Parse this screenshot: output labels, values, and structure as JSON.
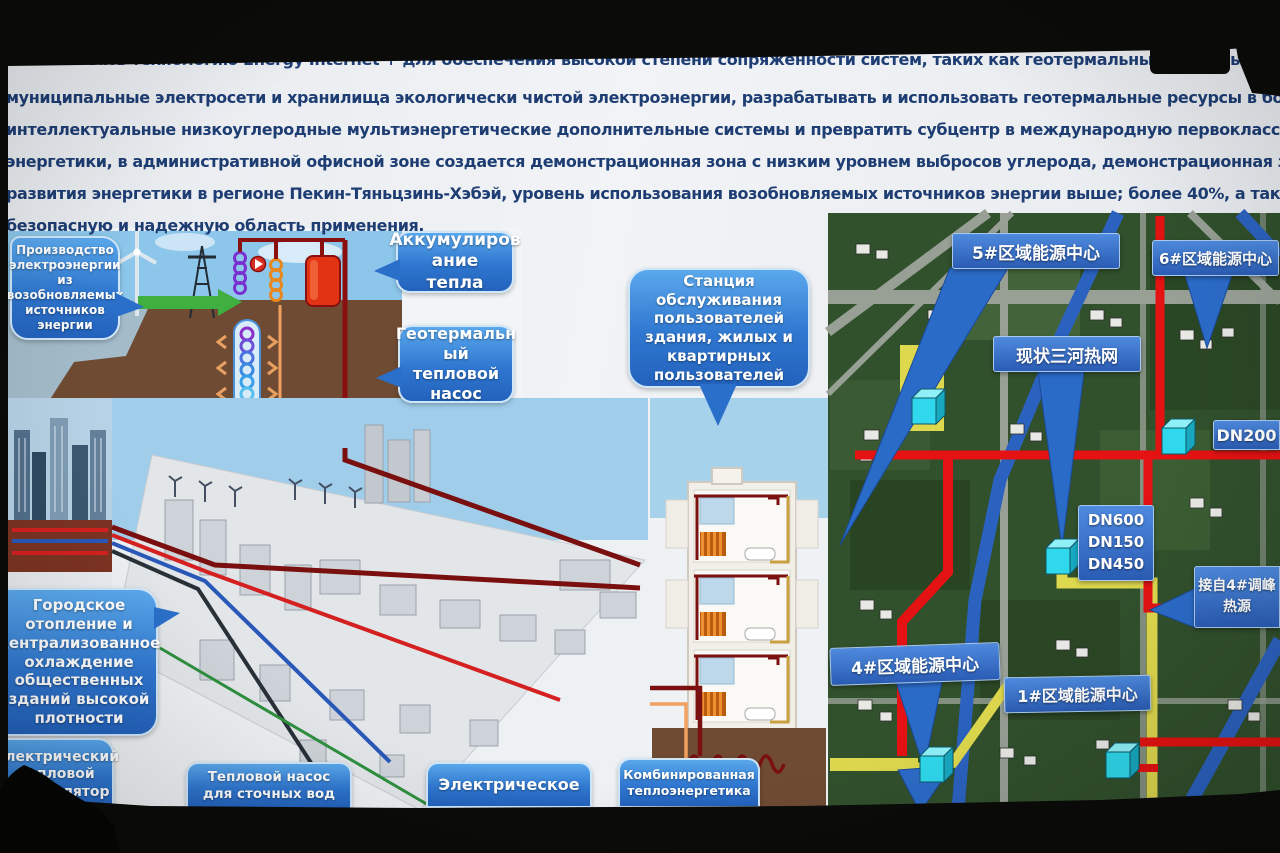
{
  "slide": {
    "paragraph_lines": [
      "использовать технологию Energy Internet + для обеспечения высокой степени сопряженности систем, таких как геотермальные тепловые насосы, газораспределение,",
      "муниципальные электросети и хранилища экологически чистой электроэнергии, разрабатывать и использовать геотермальные ресурсы в больших масштабах, создавать",
      "интеллектуальные низкоуглеродные мультиэнергетические дополнительные системы и превратить субцентр в международную первоклассную демонстрационную зону",
      "энергетики, в административной офисной зоне создается демонстрационная зона с низким уровнем выбросов углерода, демонстрационная зона скоординированного",
      "развития энергетики в регионе Пекин-Тяньцзинь-Хэбэй, уровень использования возобновляемых источников энергии выше; более 40%, а также энергоэффективную, чистую,",
      "безопасную и надежную область применения."
    ]
  },
  "callouts": {
    "renewable_generation": "Производство электроэнергии из возобновляемых источников энергии",
    "heat_accumulation": [
      "Аккумулиров",
      "ание тепла"
    ],
    "geothermal_heat_pump": [
      "Геотермальн",
      "ый тепловой",
      "насос"
    ],
    "user_service_station": "Станция обслуживания пользователей здания, жилых и квартирных пользователей",
    "district_heating": "Городское отопление и централизованное охлаждение общественных зданий высокой плотности",
    "electric_thermal_accumulator": "Электрический тепловой аккумулятор",
    "sewage_heat_pump": "Тепловой насос для сточных вод",
    "electric": "Электрическое",
    "combined_heat_power": "Комбинированная теплоэнергетика"
  },
  "map_labels": {
    "center5": "5#区域能源中心",
    "center6": "6#区域能源中心",
    "existing_network": "现状三河热网",
    "dn200": "DN200",
    "dn_sizes": [
      "DN600",
      "DN150",
      "DN450"
    ],
    "peak_source": [
      "接自4#调峰",
      "热源"
    ],
    "center4": "4#区域能源中心",
    "center1": "1#区域能源中心"
  },
  "colors": {
    "accent_blue": "#2a6fca",
    "pipe_red": "#e41212",
    "pipe_dark_red": "#7a1010",
    "pipe_yellow": "#ded84e",
    "cube_cyan": "#2fd8ec",
    "text_navy": "#1d3d73",
    "map_green": "#31502c"
  }
}
